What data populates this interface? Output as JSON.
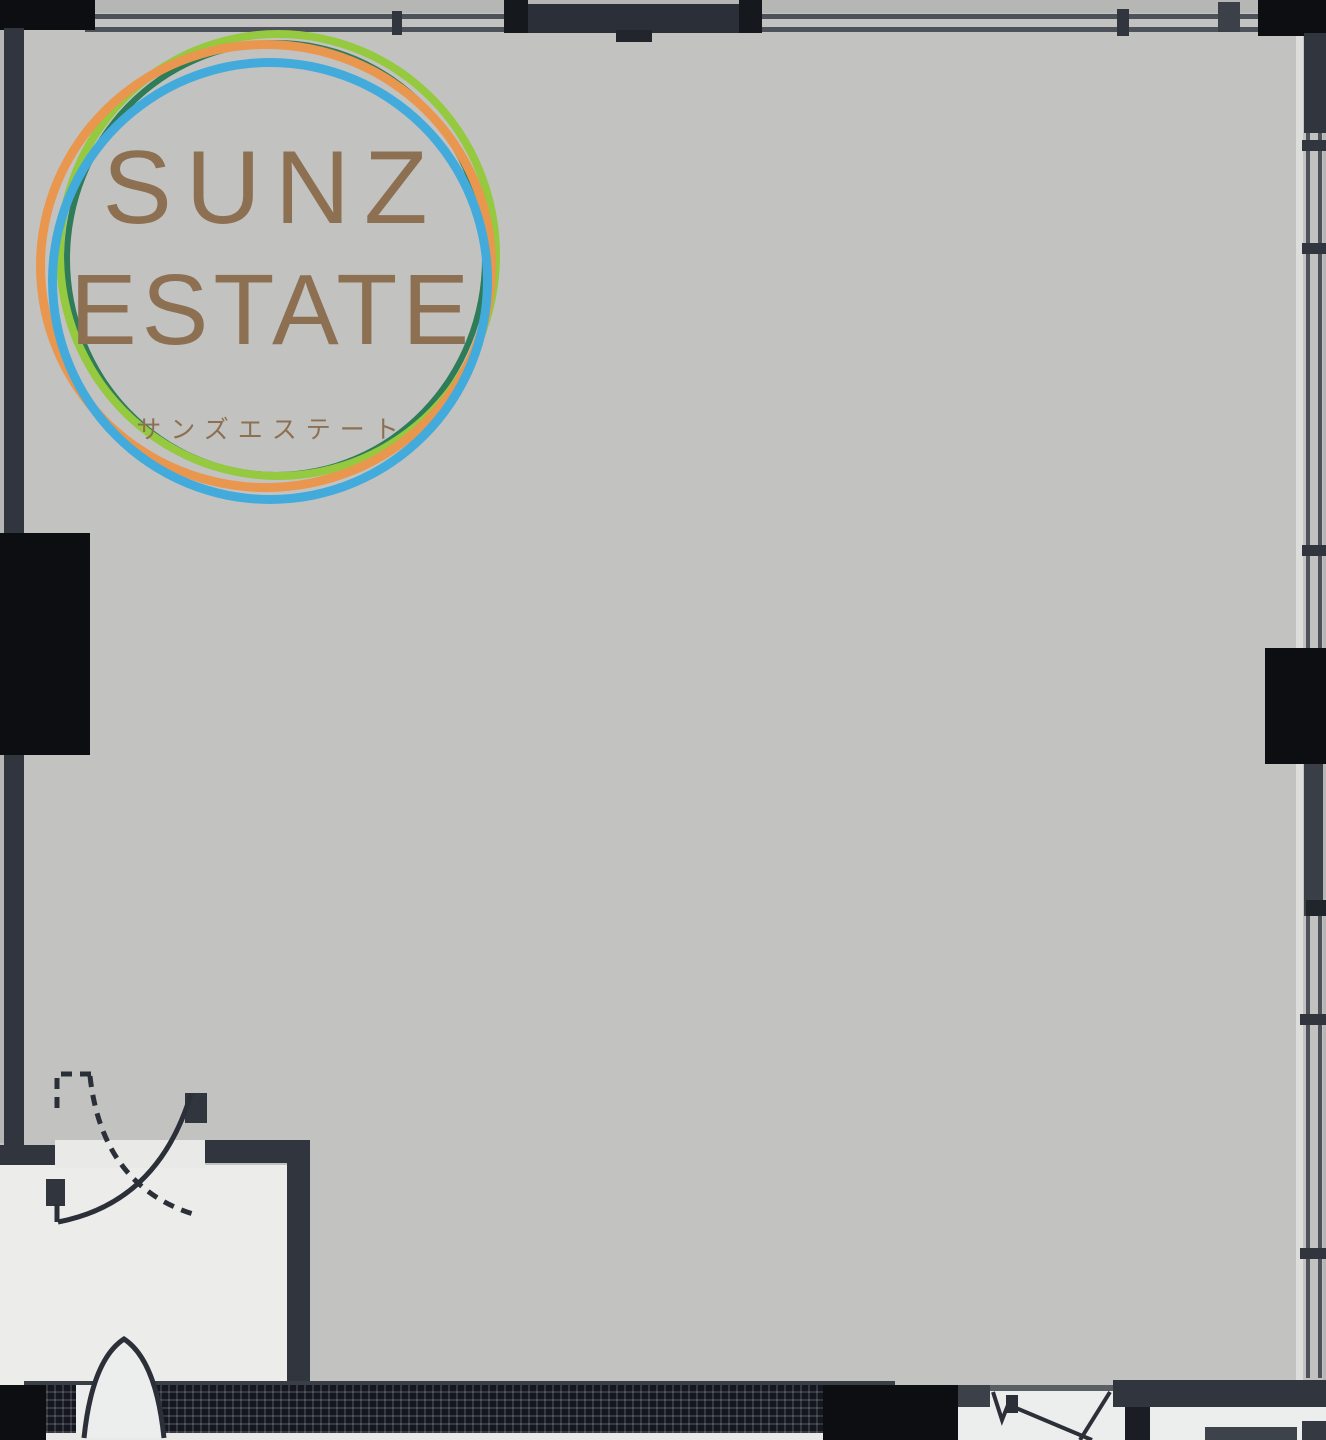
{
  "logo": {
    "line1": "SUNZ",
    "line2": "ESTATE",
    "subtext": "サンズエステート",
    "text_color": "#8d7051",
    "ring_colors": {
      "orange": "#e9974e",
      "blue": "#43abdc",
      "green": "#95c93f",
      "teal": "#2e7c58"
    }
  },
  "plan": {
    "type": "architectural floor plan, single large empty room with entrance vestibule",
    "colors": {
      "room_floor": "#c2c3c1",
      "outside": "#b6b7b5",
      "wall": "#31353d",
      "column_black": "#0c0e11",
      "window_line": "#4c515a",
      "vestibule_floor": "#ecedeb",
      "hatch_band": "#14171f"
    }
  }
}
